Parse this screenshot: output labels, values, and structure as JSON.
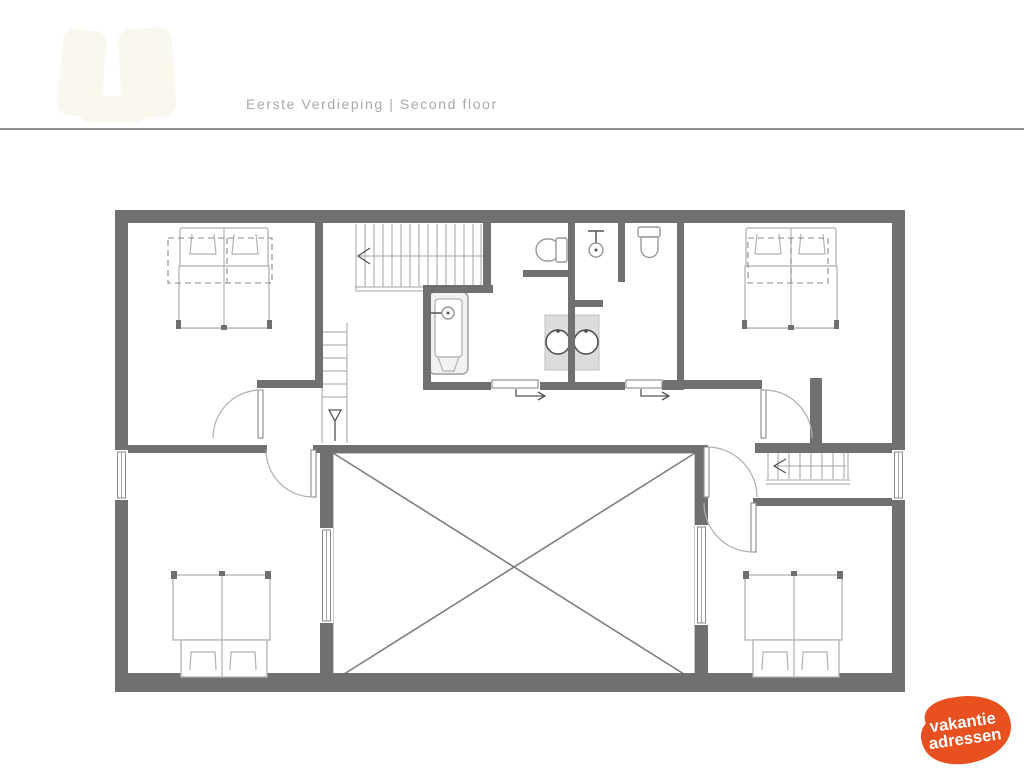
{
  "header": {
    "title": "Eerste Verdieping | Second floor"
  },
  "divider": {
    "color": "#8f8f8f"
  },
  "plan": {
    "wall_color": "#707070",
    "furniture_line_color": "#b2b2b2",
    "fixture_line_color": "#9a9a9a",
    "stair_line_color": "#a3a3a3",
    "arrow_color": "#555555",
    "sink_fill": "#dcdcdc",
    "void_cross_color": "#7e7e7e"
  },
  "watermark": {
    "color": "#faf7ee"
  },
  "logo": {
    "line1": "vakantie",
    "line2": "adressen",
    "bg_color": "#e8511f",
    "text_color": "#ffffff"
  }
}
